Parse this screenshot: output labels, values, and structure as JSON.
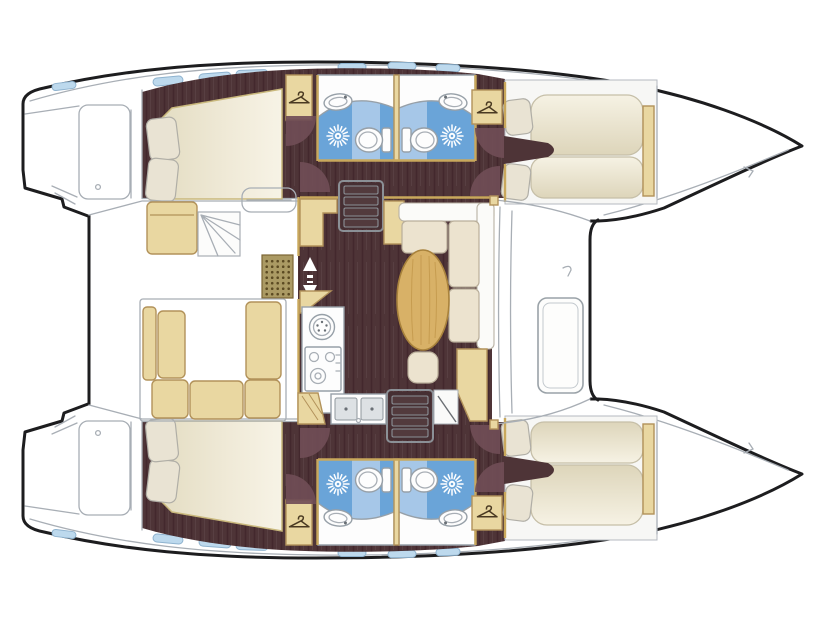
{
  "diagram": {
    "type": "boat-floor-plan",
    "vessel": "catamaran",
    "view": "top-down",
    "orientation": "bow-right",
    "text_labels": []
  },
  "palette": {
    "hull_line": "#1d1d1f",
    "outline_gray": "#a8aeb5",
    "floor_dark": "#4e3437",
    "floor_grain": "#43282d",
    "floor_grain_light": "#5f464a",
    "door_arc": "#704d56",
    "wood_tan": "#e9d7a1",
    "wood_tan_border": "#b2925a",
    "wall_tan": "#c9a85c",
    "table_wood": "#d8b167",
    "table_border": "#a8823c",
    "table_grain": "#c09648",
    "mattress_edge": "#c9b87c",
    "pillow": "#e9e3d3",
    "sofa_cushion": "#ece3cf",
    "sofa_back": "#fbfbf9",
    "bath_blue": "#6aa4d8",
    "bath_blue_light": "#a6c7e8",
    "window_blue": "#bdd9ed",
    "window_border": "#8fb3cf",
    "fixture_line": "#97a0a8",
    "steel": "#dde1e4",
    "grate": "#ab9a64",
    "grate_dot": "#5c4a22",
    "deck_white": "#ffffff"
  },
  "structure": {
    "hulls": [
      {
        "name": "port-hull",
        "rooms": [
          "aft-double-cabin",
          "bathroom-aft",
          "bathroom-fore",
          "fore-cabin-twin-berths"
        ],
        "features": [
          "double-bed",
          "pillows",
          "wardrobe-aft",
          "wardrobe-fore",
          "toilet-x2",
          "washbasin-x2",
          "shower-x2",
          "hull-windows",
          "transom-steps"
        ]
      },
      {
        "name": "starboard-hull",
        "rooms": [
          "aft-double-cabin",
          "bathroom-aft",
          "bathroom-fore",
          "fore-cabin-twin-berths"
        ],
        "features": [
          "double-bed",
          "pillows",
          "wardrobe-aft",
          "wardrobe-fore",
          "toilet-x2",
          "washbasin-x2",
          "shower-x2",
          "hull-windows",
          "transom-steps"
        ]
      }
    ],
    "center": [
      "cockpit-settee",
      "cockpit-bench",
      "cockpit-steps",
      "deck-grate",
      "salon",
      "galley",
      "round-sink",
      "stove",
      "double-sink",
      "dining-table",
      "l-sofa",
      "stool",
      "companionway-stairs-x2",
      "sliding-door-marker",
      "side-deck",
      "foredeck-door",
      "trampoline"
    ]
  },
  "icons": [
    "hanger-icon",
    "shower-sunburst-icon",
    "toilet-icon",
    "washbasin-icon",
    "stove-burners-icon",
    "sink-icon",
    "stairs-icon",
    "door-swing-arc-icon",
    "up-arrow-icon",
    "down-arrow-icon",
    "hull-window-icon",
    "deck-grate-icon"
  ]
}
